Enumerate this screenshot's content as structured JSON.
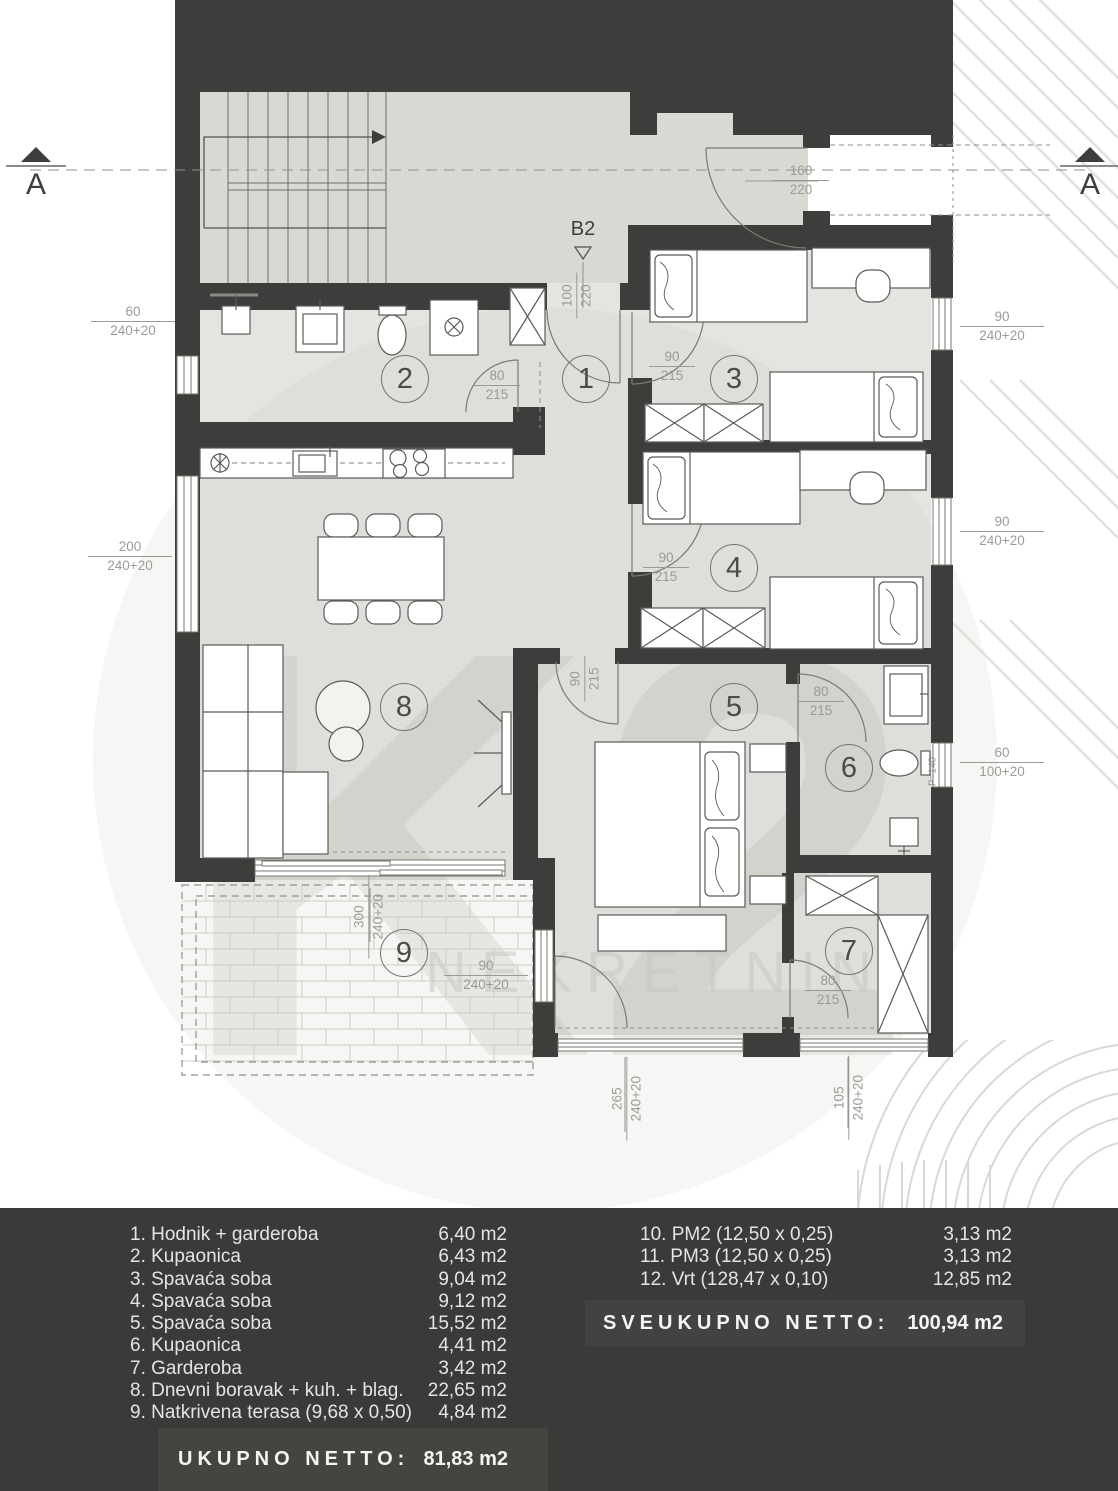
{
  "plan": {
    "section_left": "A",
    "section_right": "A",
    "unit_label": "B2",
    "watermark_logo": "K2",
    "watermark_text": "NEKRETNINE",
    "parapet": "P=140",
    "rooms": {
      "r1": "1",
      "r2": "2",
      "r3": "3",
      "r4": "4",
      "r5": "5",
      "r6": "6",
      "r7": "7",
      "r8": "8",
      "r9": "9"
    },
    "door_dims": {
      "entry_outer": {
        "w": "160",
        "h": "220"
      },
      "entry_unit": {
        "w": "100",
        "h": "220"
      },
      "bath2": {
        "w": "80",
        "h": "215"
      },
      "room3": {
        "w": "90",
        "h": "215"
      },
      "room4": {
        "w": "90",
        "h": "215"
      },
      "room5": {
        "w": "90",
        "h": "215"
      },
      "bath6": {
        "w": "80",
        "h": "215"
      },
      "room7": {
        "w": "80",
        "h": "215"
      }
    },
    "window_dims": {
      "left_small": {
        "w": "60",
        "h": "240+20"
      },
      "left_large": {
        "w": "200",
        "h": "240+20"
      },
      "right_room3": {
        "w": "90",
        "h": "240+20"
      },
      "right_room4": {
        "w": "90",
        "h": "240+20"
      },
      "right_bath6": {
        "w": "60",
        "h": "100+20"
      },
      "terrace_side": {
        "w": "90",
        "h": "240+20"
      },
      "terrace_front": {
        "w": "300",
        "h": "240+20"
      },
      "bottom_room5": {
        "w": "265",
        "h": "240+20"
      },
      "bottom_room7": {
        "w": "105",
        "h": "240+20"
      }
    }
  },
  "legend": {
    "left_rows": [
      {
        "label": "1. Hodnik + garderoba",
        "area": "6,40 m2"
      },
      {
        "label": "2. Kupaonica",
        "area": "6,43 m2"
      },
      {
        "label": "3. Spavaća soba",
        "area": "9,04 m2"
      },
      {
        "label": "4. Spavaća soba",
        "area": "9,12 m2"
      },
      {
        "label": "5. Spavaća soba",
        "area": "15,52 m2"
      },
      {
        "label": "6. Kupaonica",
        "area": "4,41 m2"
      },
      {
        "label": "7. Garderoba",
        "area": "3,42 m2"
      },
      {
        "label": "8. Dnevni boravak + kuh. + blag.",
        "area": "22,65 m2"
      },
      {
        "label": "9. Natkrivena terasa (9,68 x 0,50)",
        "area": "4,84 m2"
      }
    ],
    "right_rows": [
      {
        "label": "10. PM2 (12,50 x 0,25)",
        "area": "3,13 m2"
      },
      {
        "label": "11. PM3 (12,50 x 0,25)",
        "area": "3,13 m2"
      },
      {
        "label": "12. Vrt (128,47 x 0,10)",
        "area": "12,85 m2"
      }
    ],
    "total_all": {
      "label": "SVEUKUPNO NETTO:",
      "value": "100,94 m2"
    },
    "total_main": {
      "label": "UKUPNO NETTO:",
      "value": "81,83 m2"
    }
  }
}
